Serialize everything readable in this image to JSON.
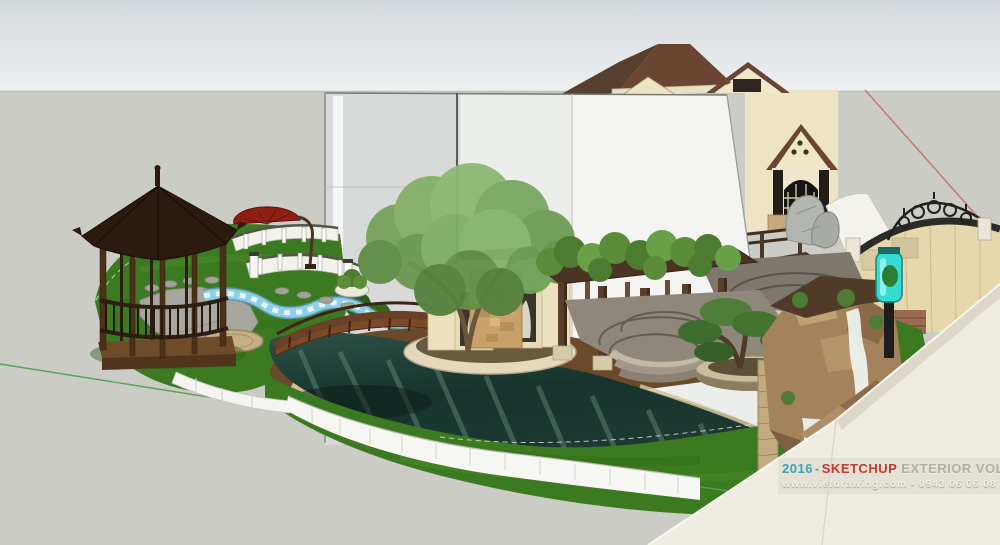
{
  "watermark": {
    "year": "2016",
    "separator": "-",
    "brand": "SKETCHUP",
    "title_rest": "EXTERIOR VOL.16",
    "contact": "www.vietdrawing.com - 0943 06 06 08",
    "colors": {
      "year": "#33a7b5",
      "brand": "#c23b2e",
      "title_rest": "#b3aea4",
      "contact": "#f0efe9"
    }
  },
  "scene": {
    "description": "SketchUp 3D exterior render of a villa garden: hexagonal wooden gazebo, red cantilever umbrella, white curved balustrades, stepping-stone paths, blue tiled stream, dark koi pond with arched wooden bridge, central stone feature wall with statue niches, large tree, vine-covered pergola, fan-pattern stone patio, bonsai in a round planter, rock waterfall, curved ornamental wall with wrought-iron crest, cyan aquarium lamp column, cream villa with hip roofs and arched window, translucent white section planes, SketchUp red and green axis lines",
    "colors": {
      "sky_top": "#d3d8dc",
      "sky_bottom": "#eef1f2",
      "ground": "#cbccc6",
      "grass": "#3c7a21",
      "pond_water": "#21423a",
      "pool_tile": "#8fcee8",
      "deck_wood": "#6a4a2b",
      "gazebo_wood": "#3a2517",
      "umbrella": "#8e1f12",
      "house_wall": "#efe7c6",
      "roof": "#6a4532",
      "feature_stone": "#c9a26b",
      "waterfall_rock": "#a4835c",
      "lamp_teal": "#35dcd4",
      "axis_red": "#c0796b",
      "axis_green": "#57a05a"
    }
  }
}
